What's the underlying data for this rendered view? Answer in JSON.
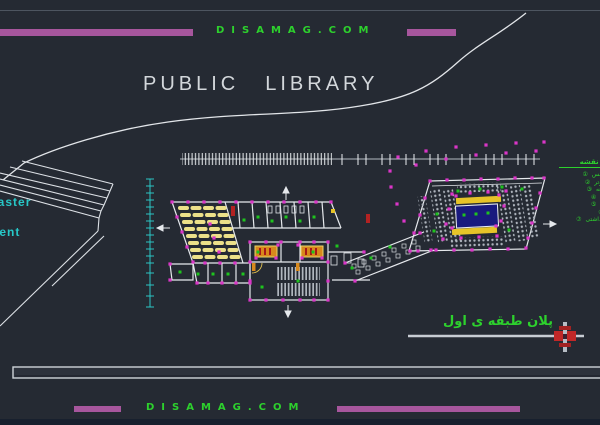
{
  "site": {
    "name": "DISAMAG.COM"
  },
  "header": {
    "title_word1": "PUBLIC",
    "title_word2": "LIBRARY"
  },
  "roadside_labels": {
    "master": "master",
    "student": "student"
  },
  "caption": {
    "floor_plan": "پلان طبقه ی اول"
  },
  "legend": {
    "title": "راهنمای نقشه",
    "items": [
      {
        "num": "①",
        "label": "سالن کنفرانس"
      },
      {
        "num": "②",
        "label": "سالن کامپیوتر"
      },
      {
        "num": "③",
        "label": "سالن مطالعه"
      },
      {
        "num": "④",
        "label": "مخزن کتاب"
      },
      {
        "num": "⑤",
        "label": "بخش اداری"
      },
      {
        "num": "⑥",
        "label": "آبدارخانه"
      },
      {
        "num": "⑦",
        "label": "سرویس بهداشتی"
      },
      {
        "num": "⑧",
        "label": "ورودی"
      }
    ]
  },
  "footer": {
    "site": "DISAMAG.COM"
  },
  "colors": {
    "background": "#252a33",
    "accent_purple": "#a7569d",
    "brand_green": "#2dd12d",
    "dim_cyan": "#27c8c8",
    "grip_magenta": "#da36c8",
    "furniture_yellow": "#ece089",
    "table_orange": "#d8891c",
    "feature_blue": "#191a7e",
    "cursor_red": "#c02828",
    "line_white": "#e6e9ed"
  }
}
